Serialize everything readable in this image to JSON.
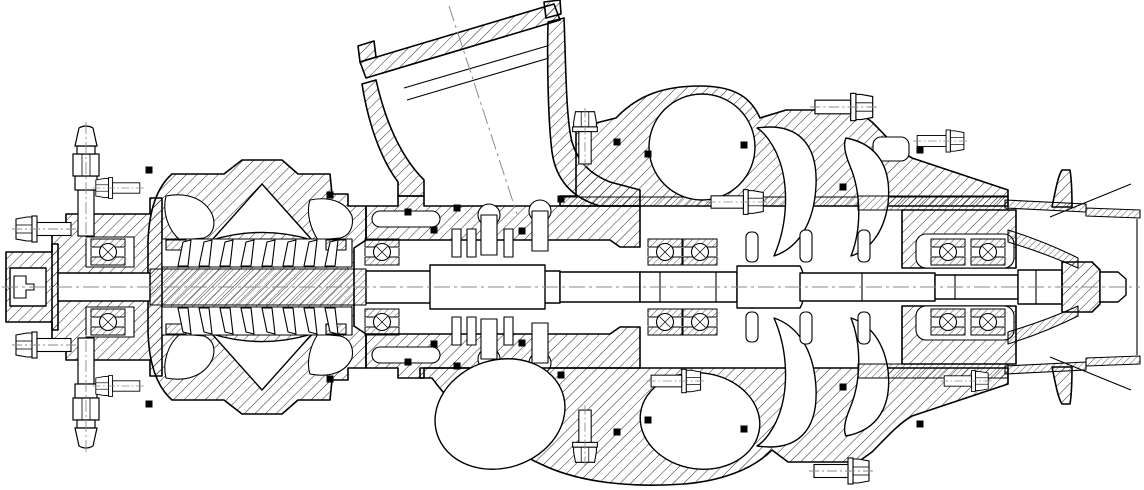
{
  "meta": {
    "title": "Sectional engineering drawing of a multi-stage turbomachine (gas turbine / turbocharger cross-section)",
    "drawing_type": "engineering-cross-section",
    "background_color": "#ffffff",
    "line_color": "#000000",
    "centerline_color": "#8a8a8a"
  },
  "canvas": {
    "width": 1144,
    "height": 490,
    "axis_y": 287
  },
  "components": [
    {
      "name": "drive-coupling",
      "label": "splined drive coupling (left shaft end)"
    },
    {
      "name": "front-bearing-housing",
      "label": "front bearing housing with flange bolts"
    },
    {
      "name": "lubrication-fittings",
      "label": "vertical stud fittings top and bottom"
    },
    {
      "name": "stage-casing",
      "label": "double-impeller stage casing"
    },
    {
      "name": "intake-duct",
      "label": "inclined intake duct with flange"
    },
    {
      "name": "seal-housing",
      "label": "central labyrinth-seal housing"
    },
    {
      "name": "compressor-volute",
      "label": "upper scroll / volute"
    },
    {
      "name": "discharge-volutes",
      "label": "lower twin scroll cavities"
    },
    {
      "name": "turbine-rotor",
      "label": "curved blade channels of rotor"
    },
    {
      "name": "rear-bearing-housing",
      "label": "rear double ball-bearing housing"
    },
    {
      "name": "exhaust-diffuser",
      "label": "exhaust cone and duct (right end)"
    },
    {
      "name": "shaft",
      "label": "main shaft with end nut"
    }
  ],
  "drawing": {
    "main_centerline": {
      "x1": 2,
      "y1": 287,
      "x2": 1140,
      "y2": 287
    },
    "intake_centerline": {
      "x1": 449,
      "y1": 6,
      "x2": 517,
      "y2": 214
    },
    "bearing_geometry": {
      "dy": 35,
      "w": 34,
      "h": 26
    },
    "bearings": [
      {
        "x": 108
      },
      {
        "x": 382
      },
      {
        "x": 665
      },
      {
        "x": 700
      },
      {
        "x": 948
      },
      {
        "x": 988
      }
    ],
    "bolts": [
      {
        "x": 30,
        "y": 229,
        "rot": 0,
        "s": 1.0
      },
      {
        "x": 30,
        "y": 345,
        "rot": 0,
        "s": 1.0
      },
      {
        "x": 107,
        "y": 188,
        "rot": 0,
        "s": 0.8
      },
      {
        "x": 107,
        "y": 386,
        "rot": 0,
        "s": 0.8
      },
      {
        "x": 585,
        "y": 125,
        "rot": 90,
        "s": 0.95
      },
      {
        "x": 585,
        "y": 449,
        "rot": -90,
        "s": 0.95
      },
      {
        "x": 750,
        "y": 202,
        "rot": 180,
        "s": 0.95
      },
      {
        "x": 688,
        "y": 381,
        "rot": 180,
        "s": 0.9
      },
      {
        "x": 858,
        "y": 107,
        "rot": 180,
        "s": 1.05
      },
      {
        "x": 855,
        "y": 471,
        "rot": 180,
        "s": 1.0
      },
      {
        "x": 952,
        "y": 141,
        "rot": 180,
        "s": 0.85
      },
      {
        "x": 977,
        "y": 381,
        "rot": 180,
        "s": 0.8
      }
    ],
    "studs": [
      {
        "x": 86,
        "y": 234,
        "flip": false
      },
      {
        "x": 86,
        "y": 340,
        "flip": true
      }
    ],
    "seal_markers": [
      [
        149,
        170
      ],
      [
        330,
        195
      ],
      [
        408,
        212
      ],
      [
        434,
        230
      ],
      [
        457,
        208
      ],
      [
        522,
        231
      ],
      [
        561,
        199
      ],
      [
        617,
        142
      ],
      [
        648,
        154
      ],
      [
        744,
        145
      ],
      [
        843,
        187
      ],
      [
        920,
        150
      ],
      [
        149,
        404
      ],
      [
        330,
        379
      ],
      [
        408,
        362
      ],
      [
        434,
        344
      ],
      [
        457,
        366
      ],
      [
        522,
        343
      ],
      [
        561,
        375
      ],
      [
        617,
        432
      ],
      [
        648,
        420
      ],
      [
        744,
        429
      ],
      [
        843,
        387
      ],
      [
        920,
        424
      ]
    ],
    "vane_rows": [
      {
        "x0": 178,
        "count": 8,
        "dx": 21,
        "y_base": 266,
        "dy": -26
      },
      {
        "x0": 178,
        "count": 8,
        "dx": 21,
        "y_base": 308,
        "dy": 26
      }
    ]
  }
}
